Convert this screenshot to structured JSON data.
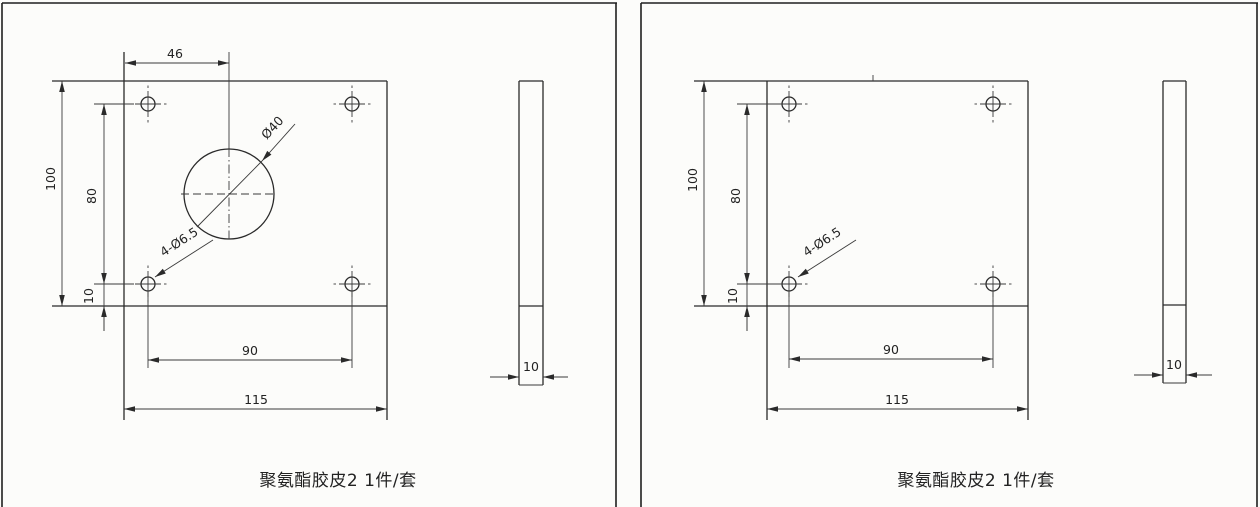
{
  "page": {
    "background": "#fcfcfa",
    "line_color": "#2a2a2a",
    "description_note": "two-panel engineering drawing of polyurethane rubber plates"
  },
  "left_panel": {
    "caption": "聚氨酯胶皮2 1件/套",
    "front_view": {
      "top_hole_offset": "46",
      "plate_height": "100",
      "hole_span_vertical": "80",
      "hole_bottom_offset": "10",
      "hole_span_horizontal": "90",
      "plate_width": "115",
      "center_hole_dia": "Ø40",
      "corner_holes": "4-Ø6.5"
    },
    "side_view": {
      "thickness": "10"
    }
  },
  "right_panel": {
    "caption": "聚氨酯胶皮2 1件/套",
    "front_view": {
      "plate_height": "100",
      "hole_span_vertical": "80",
      "hole_bottom_offset": "10",
      "hole_span_horizontal": "90",
      "plate_width": "115",
      "corner_holes": "4-Ø6.5"
    },
    "side_view": {
      "thickness": "10"
    }
  }
}
